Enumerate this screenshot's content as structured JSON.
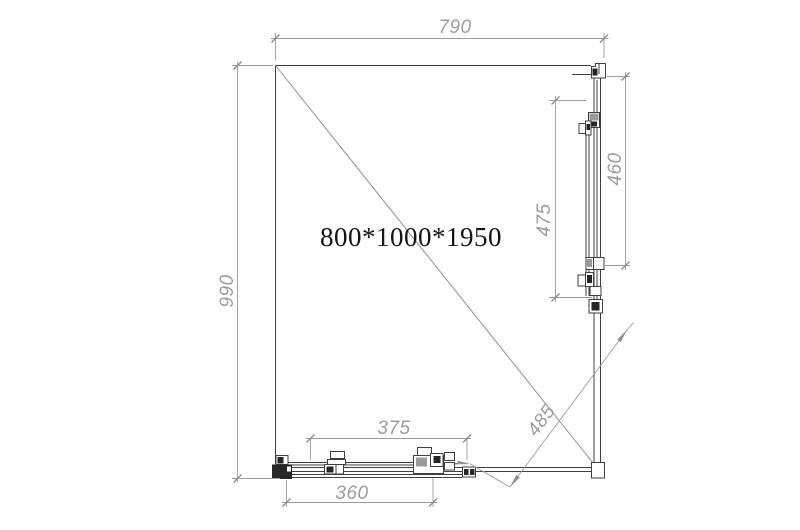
{
  "drawing": {
    "title": "800*1000*1950",
    "dimensions": {
      "top_width": "790",
      "left_depth": "990",
      "side_panel_length": "475",
      "side_glass_length": "460",
      "bottom_panel_length": "375",
      "bottom_glass_length": "360",
      "corner_opening": "485"
    },
    "colors": {
      "background": "#ffffff",
      "profile_line": "#3f3f3f",
      "dimension_line": "#9c9c9c",
      "title_text": "#141414"
    }
  }
}
